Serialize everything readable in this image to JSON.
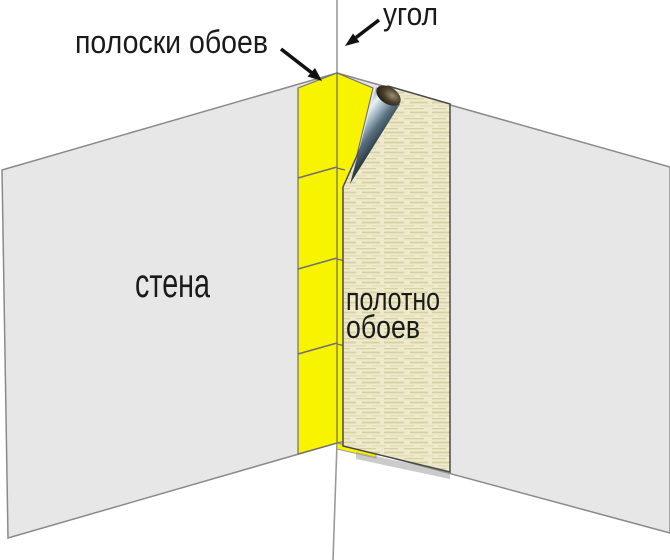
{
  "diagram": {
    "subject": "wallpapering-inside-corner",
    "labels": {
      "strips": "полоски обоев",
      "corner": "угол",
      "wall": "стена",
      "sheet_line1": "полотно",
      "sheet_line2": "обоев"
    },
    "colors": {
      "background": "#ffffff",
      "wall_gray": "#e7e7e7",
      "wall_outline": "#8a8a8a",
      "strip_yellow": "#f8f400",
      "strip_outline": "#6f6f6f",
      "sheet_base": "#eeeacb",
      "sheet_texture_dark": "#d7d0a2",
      "sheet_texture_light": "#e3ddb8",
      "sheet_outline": "#4a4a4a",
      "shadow_gray": "#a0a0a0",
      "text_black": "#1a1a1a",
      "arrow_black": "#111111"
    }
  }
}
